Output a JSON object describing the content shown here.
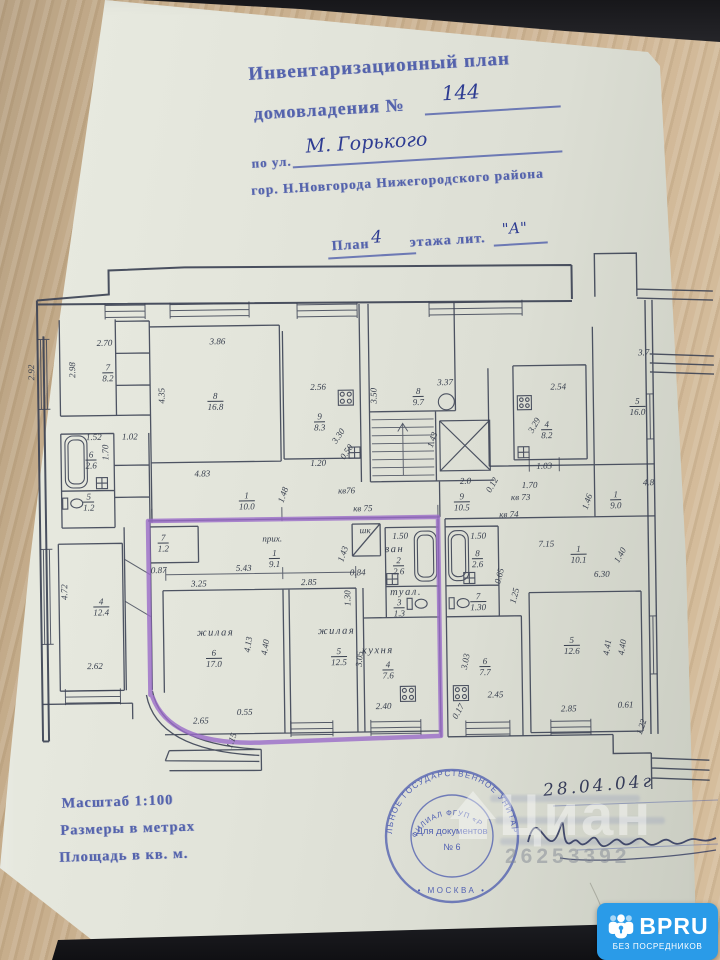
{
  "header": {
    "title": "Инвентаризационный план",
    "subtitle": "домовладения №",
    "number": "144",
    "street_label": "по ул.",
    "street_value": "М. Горького",
    "city_line": "гор. Н.Новгорода Нижегородского района",
    "plan_word": "План",
    "floor": "4",
    "plan_rest": "этажа лит.",
    "liter": "\"А\""
  },
  "footer": {
    "scale": "Масштаб 1:100",
    "units": "Размеры в метрах",
    "area": "Площадь в кв. м.",
    "date": "28.04.04г"
  },
  "stamp": {
    "ring_outer": "ЛЬНОЕ ГОСУДАРСТВЕННОЕ УНИТАРНОЕ ПРЕДП",
    "ring_inner": "ФИЛИАЛ ФГУП «Р",
    "ring_bottom": "• МОСКВА •",
    "center_line1": "Для документов",
    "center_line2": "№ 6"
  },
  "watermark": {
    "brand": "Циан",
    "number": "26253392"
  },
  "badge": {
    "brand": "BPRU",
    "tagline": "БЕЗ ПОСРЕДНИКОВ"
  },
  "plan": {
    "labels": [
      {
        "x": 107,
        "y": 340,
        "t": "2.70"
      },
      {
        "x": 75,
        "y": 366,
        "r": -90,
        "t": "2.98"
      },
      {
        "x": 34,
        "y": 368,
        "r": -90,
        "t": "2.92"
      },
      {
        "x": 110,
        "y": 370,
        "f": [
          "7",
          "8.2"
        ]
      },
      {
        "x": 220,
        "y": 340,
        "t": "3.86"
      },
      {
        "x": 164,
        "y": 393,
        "r": -90,
        "t": "4.35"
      },
      {
        "x": 217,
        "y": 400,
        "f": [
          "8",
          "16.8"
        ]
      },
      {
        "x": 320,
        "y": 387,
        "t": "2.56"
      },
      {
        "x": 321,
        "y": 422,
        "f": [
          "9",
          "8.3"
        ]
      },
      {
        "x": 340,
        "y": 436,
        "r": -55,
        "t": "3.30"
      },
      {
        "x": 348,
        "y": 452,
        "r": -55,
        "t": "0.50"
      },
      {
        "x": 319,
        "y": 463,
        "t": "1.20"
      },
      {
        "x": 95,
        "y": 434,
        "t": "1.52"
      },
      {
        "x": 92,
        "y": 457,
        "f": [
          "6",
          "2.6"
        ]
      },
      {
        "x": 107,
        "y": 449,
        "r": -90,
        "t": "1.70"
      },
      {
        "x": 89,
        "y": 499,
        "f": [
          "5",
          "1.2"
        ]
      },
      {
        "x": 131,
        "y": 434,
        "t": "1.02"
      },
      {
        "x": 203,
        "y": 472,
        "t": "4.83"
      },
      {
        "x": 247,
        "y": 500,
        "f": [
          "1",
          "10.0"
        ]
      },
      {
        "x": 284,
        "y": 494,
        "r": -70,
        "t": "1.48"
      },
      {
        "x": 376,
        "y": 396,
        "r": -90,
        "t": "3.50"
      },
      {
        "x": 420,
        "y": 398,
        "f": [
          "8",
          "9.7"
        ]
      },
      {
        "x": 447,
        "y": 384,
        "t": "3.37"
      },
      {
        "x": 434,
        "y": 441,
        "r": -70,
        "t": "1.43"
      },
      {
        "x": 466,
        "y": 483,
        "t": "2.0"
      },
      {
        "x": 493,
        "y": 487,
        "r": -60,
        "t": "0.12"
      },
      {
        "x": 462,
        "y": 504,
        "f": [
          "9",
          "10.5"
        ]
      },
      {
        "x": 347,
        "y": 491,
        "t": "кв76"
      },
      {
        "x": 363,
        "y": 509,
        "t": "кв 75"
      },
      {
        "x": 545,
        "y": 469,
        "t": "1.03"
      },
      {
        "x": 530,
        "y": 488,
        "t": "1.70"
      },
      {
        "x": 521,
        "y": 500,
        "t": "кв 73"
      },
      {
        "x": 509,
        "y": 517,
        "t": "кв 74"
      },
      {
        "x": 588,
        "y": 505,
        "r": -70,
        "t": "1.46"
      },
      {
        "x": 616,
        "y": 504,
        "f": [
          "1",
          "9.0"
        ]
      },
      {
        "x": 649,
        "y": 487,
        "t": "4.8"
      },
      {
        "x": 560,
        "y": 390,
        "t": "2.54"
      },
      {
        "x": 548,
        "y": 433,
        "f": [
          "4",
          "8.2"
        ]
      },
      {
        "x": 536,
        "y": 428,
        "r": -60,
        "t": "3.29"
      },
      {
        "x": 639,
        "y": 411,
        "f": [
          "5",
          "16.0"
        ]
      },
      {
        "x": 646,
        "y": 357,
        "t": "3.7"
      },
      {
        "x": 546,
        "y": 547,
        "t": "7.15"
      },
      {
        "x": 578,
        "y": 558,
        "f": [
          "1",
          "10.1"
        ]
      },
      {
        "x": 601,
        "y": 578,
        "t": "6.30"
      },
      {
        "x": 620,
        "y": 559,
        "r": -60,
        "t": "1.40"
      },
      {
        "x": 478,
        "y": 538,
        "t": "1.50"
      },
      {
        "x": 477,
        "y": 561,
        "f": [
          "8",
          "2.6"
        ]
      },
      {
        "x": 477,
        "y": 604,
        "f": [
          "7",
          "1.30"
        ]
      },
      {
        "x": 499,
        "y": 578,
        "r": -75,
        "t": "0.65"
      },
      {
        "x": 514,
        "y": 598,
        "r": -75,
        "t": "1.25"
      },
      {
        "x": 483,
        "y": 669,
        "f": [
          "6",
          "7.7"
        ]
      },
      {
        "x": 493,
        "y": 697,
        "t": "2.45"
      },
      {
        "x": 464,
        "y": 663,
        "r": -78,
        "t": "3.03"
      },
      {
        "x": 456,
        "y": 713,
        "r": -60,
        "t": "0.17"
      },
      {
        "x": 570,
        "y": 649,
        "f": [
          "5",
          "12.6"
        ]
      },
      {
        "x": 566,
        "y": 712,
        "t": "2.85"
      },
      {
        "x": 623,
        "y": 709,
        "t": "0.61"
      },
      {
        "x": 606,
        "y": 651,
        "r": -80,
        "t": "4.41"
      },
      {
        "x": 621,
        "y": 651,
        "r": -80,
        "t": "4.40"
      },
      {
        "x": 639,
        "y": 731,
        "r": -70,
        "t": "1.22"
      },
      {
        "x": 272,
        "y": 538,
        "t": "прих."
      },
      {
        "x": 274,
        "y": 558,
        "f": [
          "1",
          "9.1"
        ]
      },
      {
        "x": 163,
        "y": 541,
        "f": [
          "7",
          "1.2"
        ]
      },
      {
        "x": 158,
        "y": 568,
        "t": "0.87"
      },
      {
        "x": 243,
        "y": 567,
        "t": "5.43"
      },
      {
        "x": 198,
        "y": 582,
        "t": "3.25"
      },
      {
        "x": 308,
        "y": 582,
        "t": "2.85"
      },
      {
        "x": 214,
        "y": 631,
        "t": "жилая",
        "c": "rm"
      },
      {
        "x": 212,
        "y": 657,
        "f": [
          "6",
          "17.0"
        ]
      },
      {
        "x": 335,
        "y": 631,
        "t": "жилая",
        "c": "rm"
      },
      {
        "x": 337,
        "y": 657,
        "f": [
          "5",
          "12.5"
        ]
      },
      {
        "x": 247,
        "y": 643,
        "r": -80,
        "t": "4.13"
      },
      {
        "x": 264,
        "y": 646,
        "r": -80,
        "t": "4.40"
      },
      {
        "x": 198,
        "y": 719,
        "t": "2.65"
      },
      {
        "x": 242,
        "y": 711,
        "t": "0.55"
      },
      {
        "x": 229,
        "y": 739,
        "r": -70,
        "t": "1.15"
      },
      {
        "x": 400,
        "y": 537,
        "t": "1.50"
      },
      {
        "x": 394,
        "y": 550,
        "t": "ван",
        "c": "rm"
      },
      {
        "x": 398,
        "y": 567,
        "f": [
          "2",
          "2.6"
        ]
      },
      {
        "x": 405,
        "y": 593,
        "t": "туал.",
        "c": "rm"
      },
      {
        "x": 398,
        "y": 609,
        "f": [
          "3",
          "1.3"
        ]
      },
      {
        "x": 343,
        "y": 554,
        "r": -70,
        "t": "1.43"
      },
      {
        "x": 357,
        "y": 573,
        "t": "0.84"
      },
      {
        "x": 347,
        "y": 598,
        "r": -90,
        "t": "1.30"
      },
      {
        "x": 365,
        "y": 531,
        "t": "шк"
      },
      {
        "x": 376,
        "y": 651,
        "t": "кухня",
        "c": "rm"
      },
      {
        "x": 386,
        "y": 671,
        "f": [
          "4",
          "7.6"
        ]
      },
      {
        "x": 381,
        "y": 707,
        "t": "2.40"
      },
      {
        "x": 358,
        "y": 659,
        "r": -85,
        "t": "3.05"
      },
      {
        "x": 100,
        "y": 604,
        "f": [
          "4",
          "12.4"
        ]
      },
      {
        "x": 64,
        "y": 588,
        "r": -90,
        "t": "4.72"
      },
      {
        "x": 93,
        "y": 663,
        "t": "2.62"
      }
    ]
  }
}
